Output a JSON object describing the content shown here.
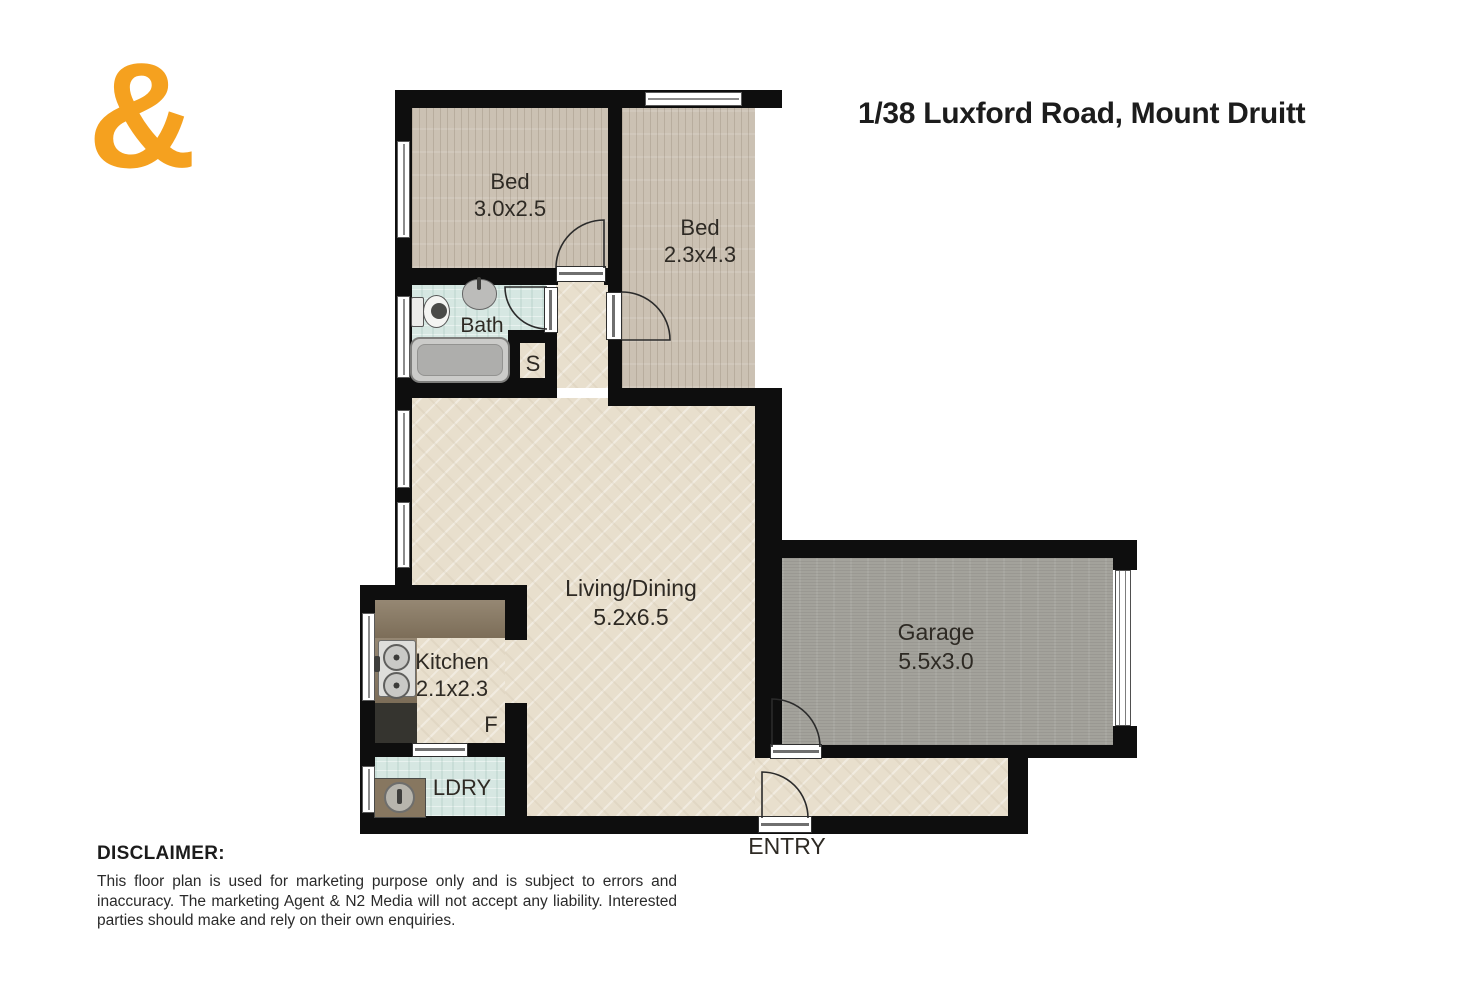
{
  "logo": {
    "symbol": "&"
  },
  "title": "1/38 Luxford Road, Mount Druitt",
  "rooms": {
    "bed1": {
      "label": "Bed",
      "dims": "3.0x2.5"
    },
    "bed2": {
      "label": "Bed",
      "dims": "2.3x4.3"
    },
    "bath": {
      "label": "Bath"
    },
    "storage": {
      "label": "S"
    },
    "living": {
      "label": "Living/Dining",
      "dims": "5.2x6.5"
    },
    "kitchen": {
      "label": "Kitchen",
      "dims": "2.1x2.3"
    },
    "fridge": {
      "label": "F"
    },
    "laundry": {
      "label": "LDRY"
    },
    "garage": {
      "label": "Garage",
      "dims": "5.5x3.0"
    },
    "entry": {
      "label": "ENTRY"
    }
  },
  "fixtures": {
    "bathroom": [
      "toilet-icon",
      "basin-icon",
      "bathtub-icon"
    ],
    "kitchen": [
      "double-sink-icon",
      "cooktop-icon"
    ],
    "laundry": [
      "laundry-tub-icon"
    ]
  },
  "disclaimer": {
    "heading": "DISCLAIMER:",
    "body": "This floor plan is used for marketing purpose only and is subject to errors and inaccuracy. The marketing Agent & N2 Media will not accept any liability. Interested parties should make and rely on their own enquiries."
  },
  "colors": {
    "logo_orange": "#F5A11F",
    "wall_black": "#0e0e0e",
    "wood_floor": "#cbc1b3",
    "herringbone_floor": "#e8dfcd",
    "tile_floor": "#d6e7e2",
    "garage_floor": "#a3a29b",
    "counter_brown": "#877760",
    "stove_dark": "#35342f",
    "label_text": "#2e2a24",
    "heading_text": "#1c1c1c"
  }
}
